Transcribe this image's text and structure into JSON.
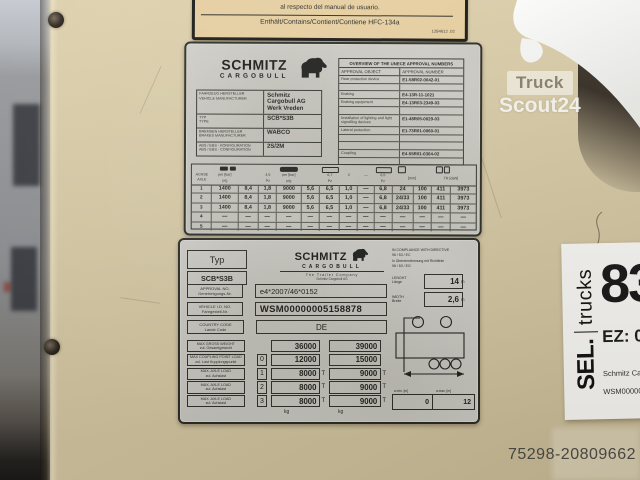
{
  "photo": {
    "watermark_line1": "Truck",
    "watermark_line2": "Scout24",
    "photo_id": "75298-20809662"
  },
  "hfc_plate": {
    "line1": "al respecto del manual de usuario.",
    "line2": "Enthält/Contains/Contient/Contiene  HFC-134a",
    "code": "1284612 .02"
  },
  "type_plate": {
    "brand1": "SCHMITZ",
    "brand2": "CARGOBULL",
    "info_rows": [
      {
        "label1": "FAHRZEUG HERSTELLER",
        "label2": "VEHICLE MANUFACTURER",
        "value": "Schmitz Cargobull AG Werk Vreden"
      },
      {
        "label1": "TYP",
        "label2": "TYPE",
        "value": "SCB*S3B"
      },
      {
        "label1": "BREMSEN HERSTELLER",
        "label2": "BRAKES MANUFACTURER",
        "value": "WABCO"
      },
      {
        "label1": "ABS / EBS - KONFIGURATION",
        "label2": "ABS / EBS - CONFIGURATION",
        "value": "2S/2M"
      }
    ],
    "approvals": {
      "title": "OVERVIEW OF THE UNECE APPROVAL NUMBERS",
      "col_object": "APPROVAL  OBJECT",
      "col_number": "APPROVAL NUMBER",
      "rows": [
        {
          "object": "Rear protection device",
          "number": "E1-58R02-0042-01"
        },
        {
          "object": "",
          "number": ""
        },
        {
          "object": "Braking",
          "number": "E4-13R-11-1021"
        },
        {
          "object": "Braking equipment",
          "number": "E4-13R03-2349-03"
        },
        {
          "object": "",
          "number": ""
        },
        {
          "object": "Installation of lighting and light signalling devices",
          "number": "E1-48R05-0029-03"
        },
        {
          "object": "Lateral protection",
          "number": "E1-73R01-0060-01"
        },
        {
          "object": "",
          "number": ""
        },
        {
          "object": "",
          "number": ""
        },
        {
          "object": "Coupling",
          "number": "E4-55R01-0304-02"
        },
        {
          "object": "",
          "number": ""
        }
      ]
    },
    "axle_table": {
      "axle_label1": "ACHSE",
      "axle_label2": "AXLE",
      "u_p1": "pm [bar]",
      "u_45": "4,5",
      "u_p2": "pm [bar]",
      "u_67": "6,7",
      "u_2": "2",
      "u_dash": "—",
      "u_65": "6,5",
      "h_pg1": "p/g",
      "h_pz1": "Pz",
      "h_pg2": "p/g",
      "h_pz2": "Pz",
      "h_pz3": "Pz",
      "h_mm": "[mm]",
      "h_tr": "TR [daN]",
      "rows": [
        [
          "1",
          "1400",
          "8,4",
          "1,8",
          "9000",
          "5,6",
          "6,5",
          "1,0",
          "—",
          "6,8",
          "24",
          "100",
          "411",
          "3973"
        ],
        [
          "2",
          "1400",
          "8,4",
          "1,8",
          "9000",
          "5,6",
          "6,5",
          "1,0",
          "—",
          "6,8",
          "24/33",
          "100",
          "411",
          "3973"
        ],
        [
          "3",
          "1400",
          "8,4",
          "1,8",
          "9000",
          "5,6",
          "6,5",
          "1,0",
          "—",
          "6,8",
          "24/33",
          "100",
          "411",
          "3973"
        ],
        [
          "4",
          "—",
          "—",
          "—",
          "—",
          "—",
          "—",
          "—",
          "—",
          "—",
          "—",
          "—",
          "—",
          "—"
        ],
        [
          "5",
          "—",
          "—",
          "—",
          "—",
          "—",
          "—",
          "—",
          "—",
          "—",
          "—",
          "—",
          "—",
          "—"
        ]
      ]
    }
  },
  "vin_plate": {
    "typ_label": "Typ",
    "typ_value": "SCB*S3B",
    "brand1": "SCHMITZ",
    "brand2": "CARGOBULL",
    "brand_sub": "The Trailer Company",
    "brand_sub2": "Schmitz Cargobull AG",
    "fields": [
      {
        "label1": "APPROVAL NO.",
        "label2": "Genehmigungs-Nr.",
        "value": "e4*2007/46*0152"
      },
      {
        "label1": "VEHICLE I.D. NO.",
        "label2": "Fahrgestell-Nr.",
        "value": "WSM00000005158878"
      },
      {
        "label1": "COUNTRY CODE",
        "label2": "Lande Code",
        "value": "DE"
      }
    ],
    "weights": {
      "rows": [
        {
          "label1": "MAX GROSS WEIGHT",
          "label2": "zul. Gesamtgewicht",
          "idx": "",
          "a": "36000",
          "ta": "",
          "b": "39000",
          "tb": ""
        },
        {
          "label1": "MAX COUPLING POINT LOAD",
          "label2": "zul. Last Kupplungspunkt",
          "idx": "0",
          "a": "12000",
          "ta": "",
          "b": "15000",
          "tb": ""
        },
        {
          "label1": "MAX. AXLE LOAD",
          "label2": "zul. Achslast",
          "idx": "1",
          "a": "8000",
          "ta": "T",
          "b": "9000",
          "tb": "T"
        },
        {
          "label1": "MAX. AXLE LOAD",
          "label2": "zul. Achslast",
          "idx": "2",
          "a": "8000",
          "ta": "T",
          "b": "9000",
          "tb": "T"
        },
        {
          "label1": "MAX. AXLE LOAD",
          "label2": "zul. Achslast",
          "idx": "3",
          "a": "8000",
          "ta": "T",
          "b": "9000",
          "tb": "T"
        }
      ],
      "unit_a": "kg",
      "unit_b": "kg"
    },
    "compliance": {
      "l1": "IN COMPLIANCE WITH DIRECTIVE",
      "l2": "96 / 53 / EC",
      "l3": "In Übereinstimmung mit Richtlinie",
      "l4": "96 / 53 / EG"
    },
    "length": {
      "label1": "LENGHT",
      "label2": "Länge",
      "value": "14",
      "unit": "m"
    },
    "width": {
      "label1": "WIDTH",
      "label2": "Breite",
      "value": "2,6",
      "unit": "m"
    },
    "dims": {
      "min_label": "a min. [m]",
      "max_label": "a max. [m]",
      "min": "0",
      "max": "12"
    }
  },
  "tag_card": {
    "brand_bold": "SEL.",
    "brand_light": "trucks",
    "big_number": "83",
    "ez_line": "EZ: 0",
    "info1": "Schmitz Cargo",
    "info2": "WSM0000000"
  }
}
